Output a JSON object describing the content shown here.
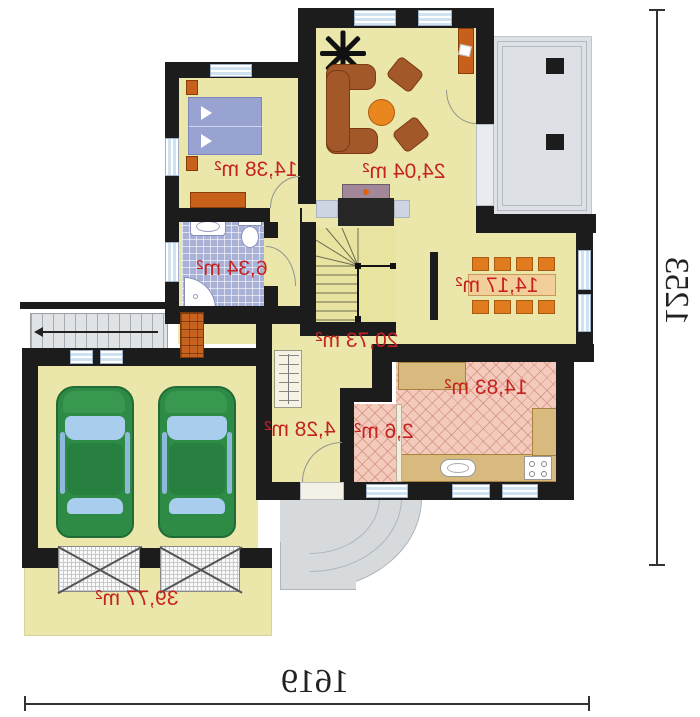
{
  "plan": {
    "rooms": [
      {
        "id": "living-room",
        "area": "24,04 m²"
      },
      {
        "id": "bedroom",
        "area": "14,38 m²"
      },
      {
        "id": "bathroom",
        "area": "6,34 m²"
      },
      {
        "id": "dining-area",
        "area": "14,17 m²"
      },
      {
        "id": "hall",
        "area": "20,73 m²"
      },
      {
        "id": "kitchen",
        "area": "14,83 m²"
      },
      {
        "id": "pantry",
        "area": "2,6 m²"
      },
      {
        "id": "entry-hall",
        "area": "4,28 m²"
      },
      {
        "id": "garage",
        "area": "39,77 m²"
      }
    ],
    "dimensions": {
      "overall_width": "1619",
      "overall_height": "1253"
    },
    "colors": {
      "wall": "#1c1c1c",
      "floor": "#ebe6aa",
      "bath_tile": "#a9b2d6",
      "kitchen_tile": "#f4cabc",
      "label_red": "#c52322",
      "window": "#cfe2f2",
      "terrace_gray": "#dde1e5",
      "car_green": "#2e8b45",
      "furniture_brown": "#a3582a",
      "furniture_orange": "#e07c1e"
    }
  }
}
